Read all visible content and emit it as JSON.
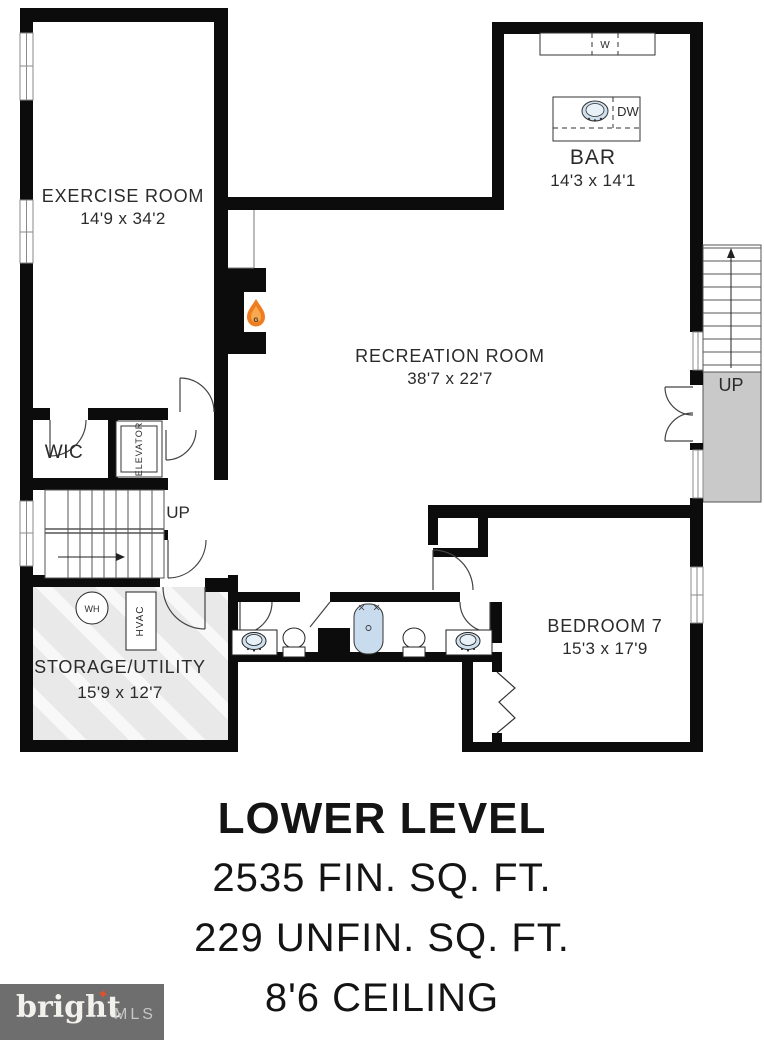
{
  "plan": {
    "rooms": {
      "exercise": {
        "name": "EXERCISE ROOM",
        "dims": "14'9 x 34'2"
      },
      "bar": {
        "name": "BAR",
        "dims": "14'3 x 14'1"
      },
      "recreation": {
        "name": "RECREATION ROOM",
        "dims": "38'7 x 22'7"
      },
      "bedroom7": {
        "name": "BEDROOM 7",
        "dims": "15'3 x 17'9"
      },
      "storage": {
        "name": "STORAGE/UTILITY",
        "dims": "15'9 x 12'7"
      },
      "wic": {
        "name": "WIC"
      }
    },
    "labels": {
      "elevator": "ELEVATOR",
      "up_left": "UP",
      "up_right": "UP",
      "washer": "W",
      "dishwasher": "DW",
      "water_heater": "WH",
      "hvac": "HVAC",
      "gas_fireplace": "G"
    }
  },
  "summary": {
    "level": "LOWER LEVEL",
    "finished": "2535 FIN. SQ. FT.",
    "unfinished": "229 UNFIN. SQ. FT.",
    "ceiling": "8'6 CEILING"
  },
  "branding": {
    "name": "bright",
    "suffix": "MLS",
    "trademark": "TM",
    "star": "✦"
  },
  "colors": {
    "wall": "#0c0c0c",
    "fixture_blue": "#cfe0ee",
    "stair_landing": "#c9c9c9",
    "flame_orange": "#ef7d20",
    "logo_bg": "#6e6e6e"
  }
}
